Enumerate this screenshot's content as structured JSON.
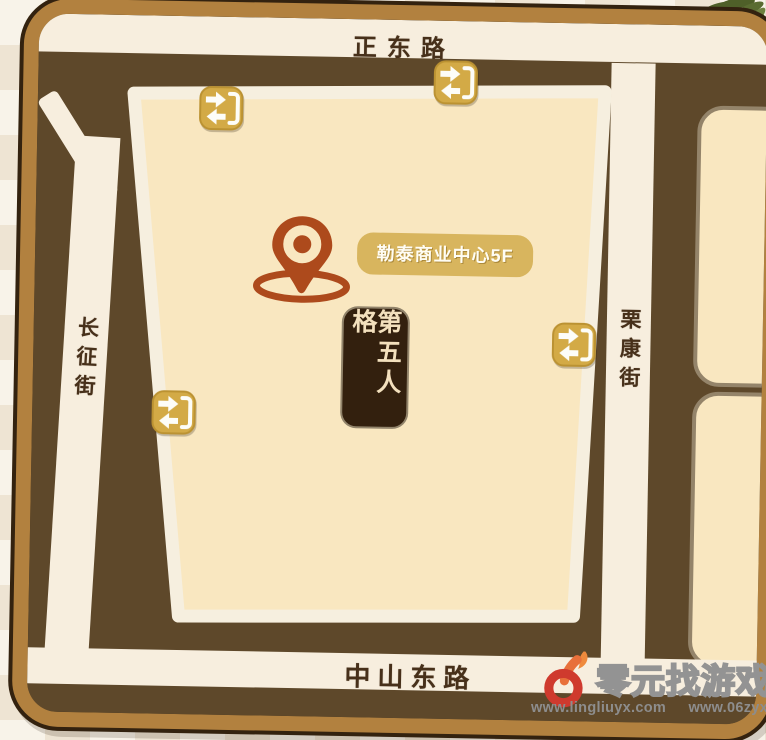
{
  "map": {
    "streets": {
      "top": "正东路",
      "bottom": "中山东路",
      "left": "长征街",
      "right": "栗康街"
    },
    "location": {
      "pin_label": "勒泰商业中心5F",
      "venue_sign": "第五人格"
    },
    "entrances": {
      "icon_name": "entrance-arrows-icon",
      "count": 4
    }
  },
  "watermark": {
    "brand": "零元找游戏",
    "url_left": "www.lingliuyx.com",
    "url_right": "www.06zyx.com"
  },
  "colors": {
    "frame": "#b2813f",
    "frame_outline": "#33220f",
    "interior": "#5e482a",
    "road": "#f7eede",
    "block": "#f9e7c0",
    "entrance_gold": "#d3aa46",
    "label_gold": "#d8b55e",
    "pin_rust": "#ad4a1c",
    "sign_bg": "#33200e",
    "street_text": "#47301a",
    "palm_green": "#5a6c31"
  }
}
